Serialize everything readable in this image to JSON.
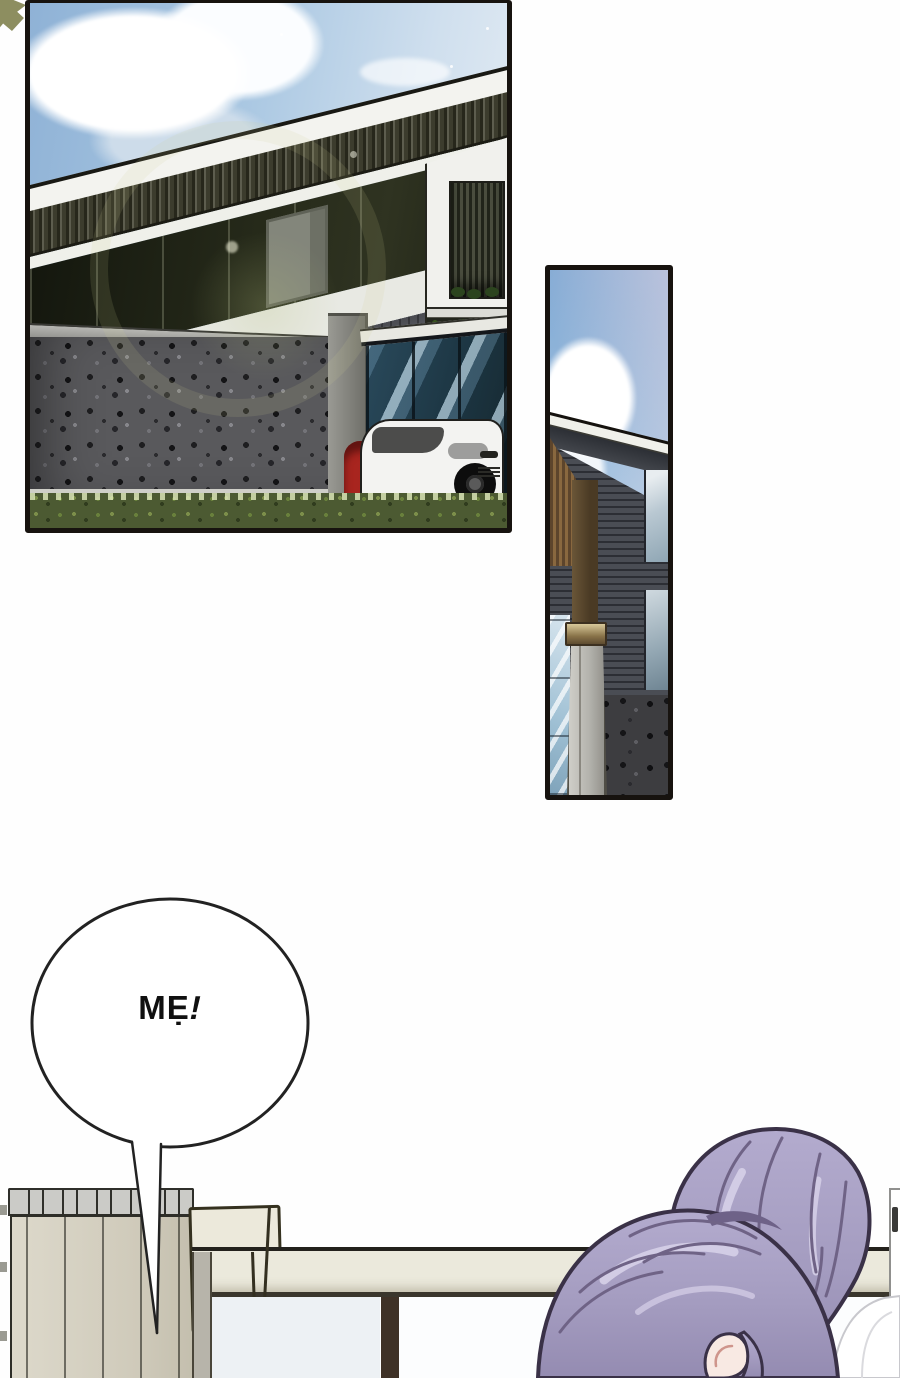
{
  "page": {
    "kind": "comic page",
    "language": "Vietnamese"
  },
  "speech_bubble": {
    "full_text": "MẸ!",
    "text_main": "MẸ",
    "text_exclaim": "!"
  },
  "panels": {
    "main": {
      "name": "house-exterior-wide-panel",
      "subject": "modern two-story house, stone wall, white SUV and red car, blue sky with clouds, lens flare"
    },
    "tall": {
      "name": "house-detail-tall-panel",
      "subject": "house corner with concrete pillar, sky and cloud"
    }
  },
  "bottom_scene": {
    "subject": "radiator and table with purple-haired character bowing head"
  },
  "colors": {
    "page_bg": "#ffffff",
    "panel_border": "#17130f",
    "sky_blue": "#8fb2d6",
    "cloud_white": "#ffffff",
    "house_band_dark": "#27271b",
    "stone_wall_gray": "#59595c",
    "glass_blue": "#2a4a5c",
    "suv_white": "#f3f3f1",
    "car_red": "#a8251f",
    "grass_green": "#4c5a32",
    "table_beige": "#ebe9dc",
    "radiator_beige": "#d6d2c4",
    "hair_lavender": "#a79fc0",
    "hair_outline": "#3a3147",
    "skin_tone": "#f8e9e3",
    "bubble_outline": "#222222",
    "corner_glyph_olive": "#8d8e60"
  }
}
